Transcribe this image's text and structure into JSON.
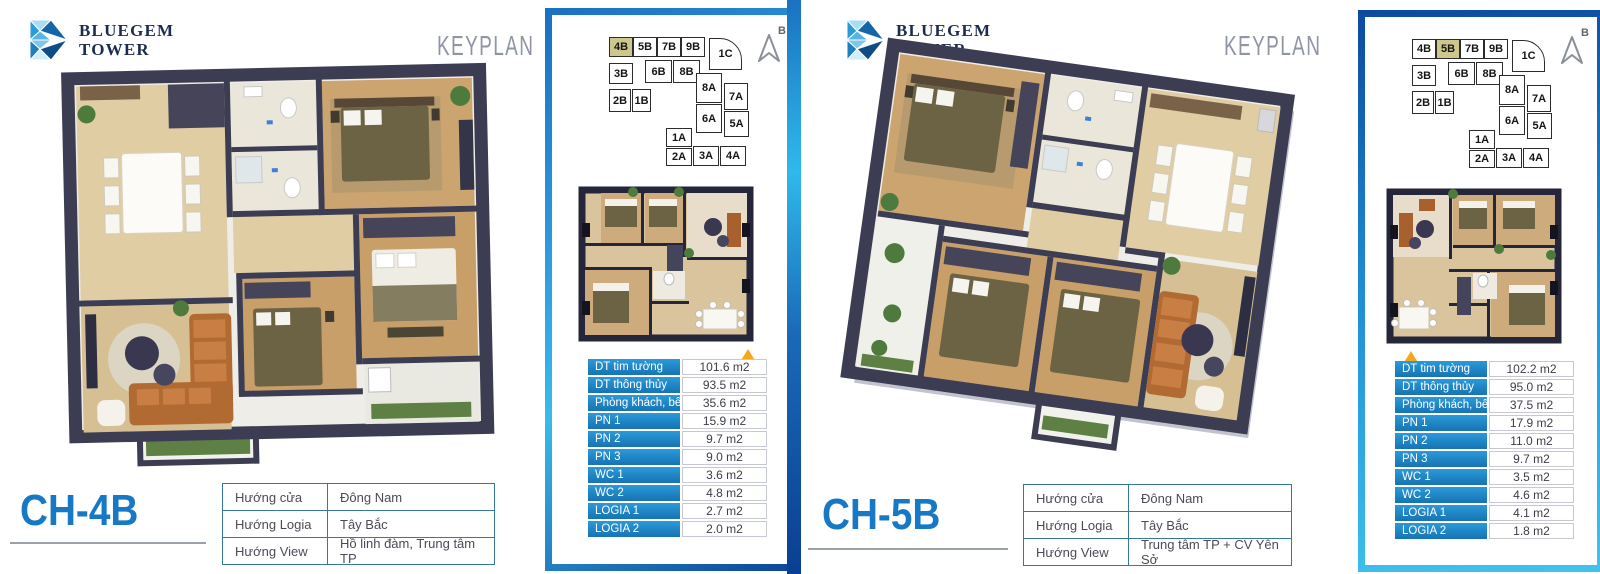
{
  "sections": [
    {
      "logo_line1": "BLUEGEM",
      "logo_line2": "TOWER",
      "keyplan_label": "KEYPLAN",
      "unit_code": "CH-4B",
      "compass_label": "B",
      "keyplan": {
        "highlight": "4B",
        "units": [
          "4B",
          "5B",
          "7B",
          "9B",
          "1C",
          "3B",
          "6B",
          "8B",
          "2B",
          "1B",
          "8A",
          "7A",
          "6A",
          "5A",
          "1A",
          "2A",
          "3A",
          "4A"
        ]
      },
      "areas": [
        {
          "label": "DT tim tường",
          "value": "101.6 m2"
        },
        {
          "label": "DT thông thủy",
          "value": "93.5 m2"
        },
        {
          "label": "Phòng khách, bếp",
          "value": "35.6 m2"
        },
        {
          "label": "PN 1",
          "value": "15.9 m2"
        },
        {
          "label": "PN 2",
          "value": "9.7 m2"
        },
        {
          "label": "PN 3",
          "value": "9.0 m2"
        },
        {
          "label": "WC 1",
          "value": "3.6 m2"
        },
        {
          "label": "WC 2",
          "value": "4.8 m2"
        },
        {
          "label": "LOGIA 1",
          "value": "2.7 m2"
        },
        {
          "label": "LOGIA 2",
          "value": "2.0 m2"
        }
      ],
      "directions": [
        {
          "label": "Hướng cửa",
          "value": "Đông Nam"
        },
        {
          "label": "Hướng Logia",
          "value": "Tây Bắc"
        },
        {
          "label": "Hướng View",
          "value": "Hồ linh đàm, Trung tâm TP"
        }
      ]
    },
    {
      "logo_line1": "BLUEGEM",
      "logo_line2": "TOWER",
      "keyplan_label": "KEYPLAN",
      "unit_code": "CH-5B",
      "compass_label": "B",
      "keyplan": {
        "highlight": "5B",
        "units": [
          "4B",
          "5B",
          "7B",
          "9B",
          "1C",
          "3B",
          "6B",
          "8B",
          "2B",
          "1B",
          "8A",
          "7A",
          "6A",
          "5A",
          "1A",
          "2A",
          "3A",
          "4A"
        ]
      },
      "areas": [
        {
          "label": "DT tim tường",
          "value": "102.2 m2"
        },
        {
          "label": "DT thông thủy",
          "value": "95.0 m2"
        },
        {
          "label": "Phòng khách, bếp",
          "value": "37.5 m2"
        },
        {
          "label": "PN 1",
          "value": "17.9 m2"
        },
        {
          "label": "PN 2",
          "value": "11.0 m2"
        },
        {
          "label": "PN 3",
          "value": "9.7 m2"
        },
        {
          "label": "WC 1",
          "value": "3.5 m2"
        },
        {
          "label": "WC 2",
          "value": "4.6 m2"
        },
        {
          "label": "LOGIA 1",
          "value": "4.1 m2"
        },
        {
          "label": "LOGIA 2",
          "value": "1.8 m2"
        }
      ],
      "directions": [
        {
          "label": "Hướng cửa",
          "value": "Đông Nam"
        },
        {
          "label": "Hướng Logia",
          "value": "Tây Bắc"
        },
        {
          "label": "Hướng View",
          "value": "Trung tâm TP + CV Yên Sở"
        }
      ]
    }
  ],
  "colors": {
    "accent_blue": "#1779c5",
    "table_header_blue": "#1d86c8",
    "panel_border_blue": "#1f8ed4",
    "highlight_unit": "#cdc68d",
    "entry_arrow_orange": "#f6a81c"
  }
}
